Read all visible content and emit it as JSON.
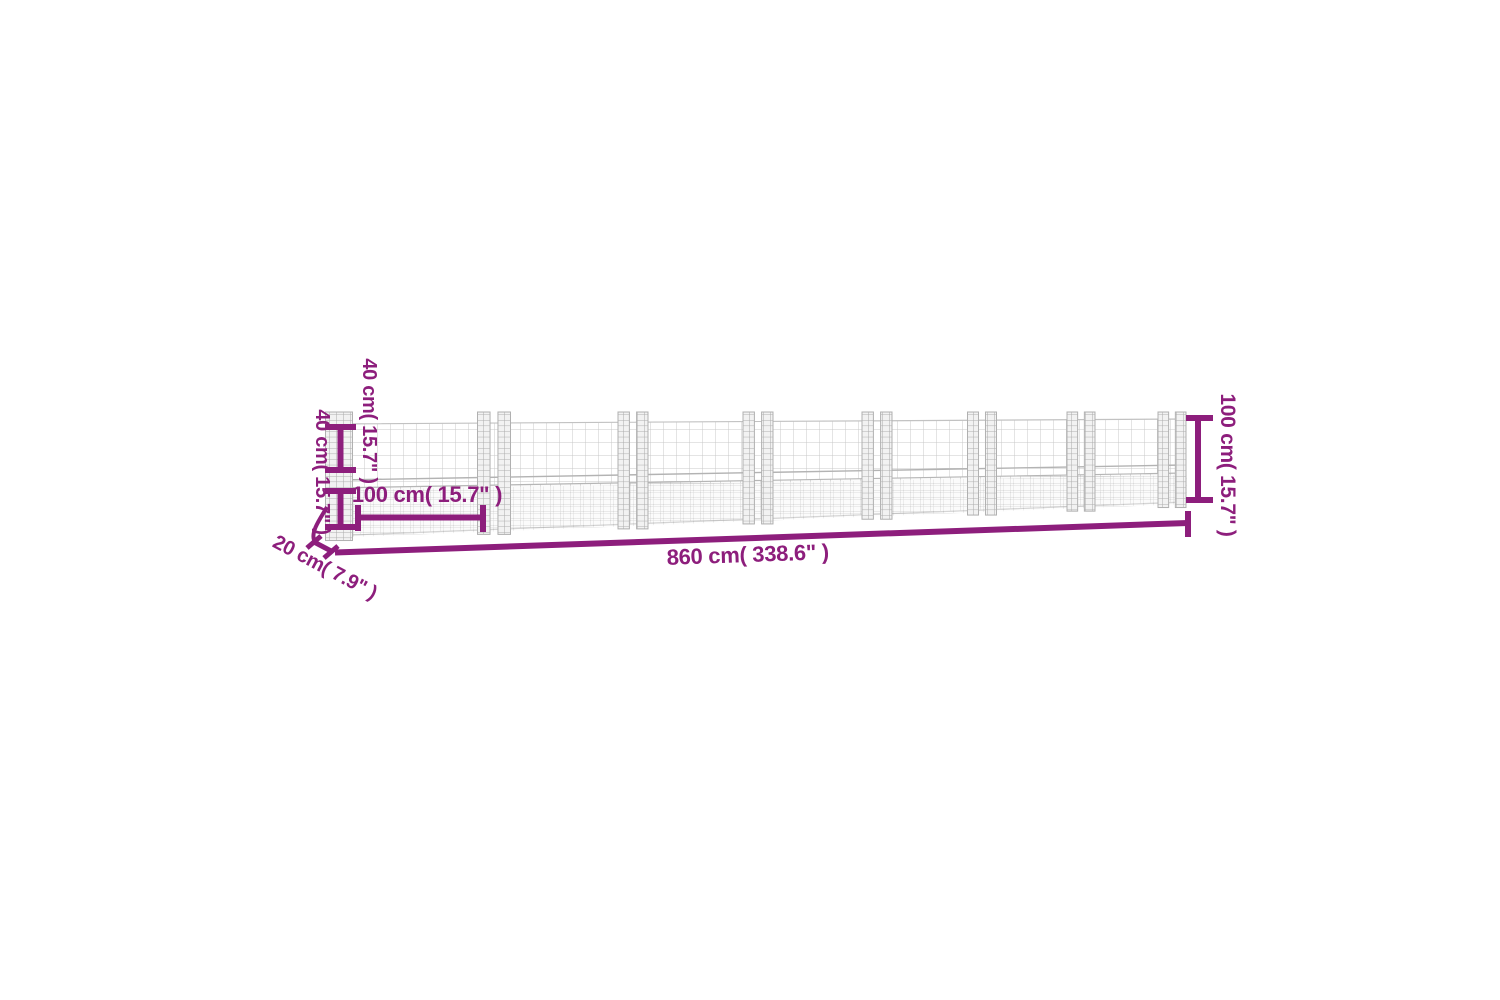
{
  "figure": {
    "type": "product-dimension-diagram",
    "background": "#ffffff",
    "accent_color": "#8d1e7c",
    "mesh_color": "#c4c4c4",
    "post_count": 8,
    "dimensions": {
      "top_mesh_height": "40 cm( 15.7\" )",
      "bottom_wall_height": "40 cm( 15.7\" )",
      "post_spacing": "100 cm( 15.7\" )",
      "overall_length": "860 cm( 338.6\" )",
      "overall_height": "100 cm( 15.7\" )",
      "depth": "20 cm( 7.9\" )"
    }
  }
}
